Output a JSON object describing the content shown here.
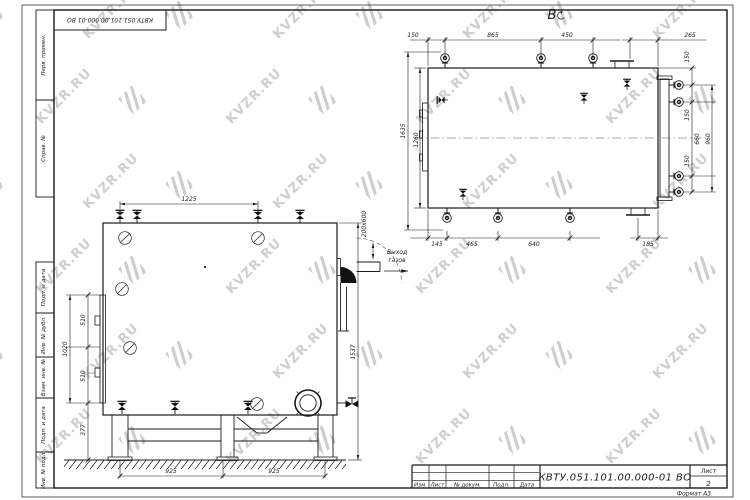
{
  "watermark": {
    "text": "KVZR.RU"
  },
  "stamp_top": {
    "text": "КВТУ.051.101.00.000-01 ВО"
  },
  "side_labels": [
    "Перв. примен.",
    "Справ. №",
    "Подп. и дата",
    "Инв. № дубл.",
    "Взам. инв. №",
    "Подп. и дата",
    "Инв. № подл."
  ],
  "view_b": {
    "label": "В",
    "rotation_icon": "rotated-view-icon",
    "dims_top": [
      "150",
      "865",
      "450",
      "265"
    ],
    "dims_bottom": [
      "145",
      "465",
      "640",
      "185"
    ],
    "dims_left": [
      "1635",
      "1260"
    ],
    "dims_right": [
      "150",
      "150",
      "660",
      "150",
      "960"
    ]
  },
  "view_front": {
    "dim_top": "1225",
    "dims_left": [
      "1020",
      "510",
      "510",
      "377"
    ],
    "dim_right": "1537",
    "dims_bottom": [
      "925",
      "925"
    ],
    "outlet": {
      "size": "200x600",
      "line1": "Выход",
      "line2": "газов"
    }
  },
  "title_block": {
    "doc_number": "КВТУ.051.101.00.000-01 ВО",
    "columns": [
      "Изм.",
      "Лист",
      "№ докум.",
      "Подп.",
      "Дата"
    ],
    "sheet_label": "Лист",
    "sheet_number": "2",
    "format_label": "Формат  А3"
  },
  "colors": {
    "line": "#1b1b1b",
    "watermark": "#c6c6c6",
    "fill_dark": "#111111"
  }
}
